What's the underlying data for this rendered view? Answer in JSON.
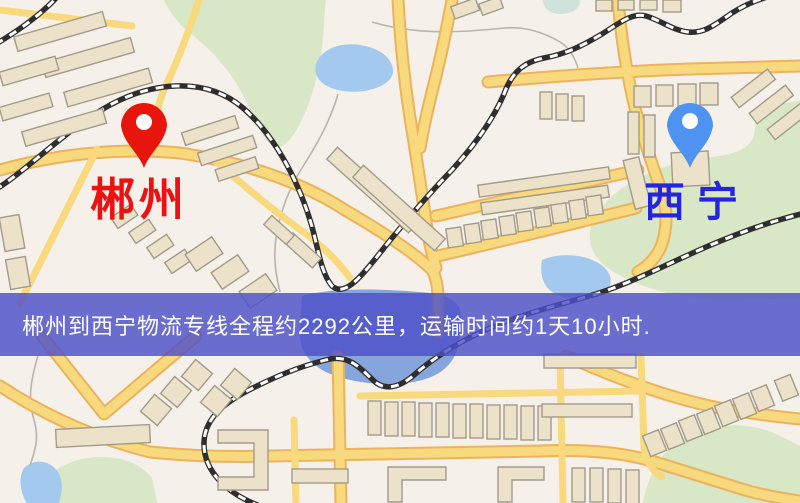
{
  "map": {
    "origin": {
      "name": "郴州",
      "pin_color": "#e8150c",
      "label_color": "#ee1111"
    },
    "destination": {
      "name": "西宁",
      "pin_color": "#4f93f2",
      "label_color": "#2525e0"
    },
    "banner": {
      "text": "郴州到西宁物流专线全程约2292公里，运输时间约1天10小时.",
      "bg_color": "rgba(77,79,200,0.82)",
      "text_color": "#ffffff"
    },
    "palette": {
      "background": "#f5f0e9",
      "road_fill": "#f8d97d",
      "road_casing": "#ecb35f",
      "building_fill": "#ebe2c9",
      "building_outline": "#a39b8a",
      "green_area": "#d8e7c5",
      "teal_area": "#cfe3da",
      "water": "#a3c9ee",
      "water_dark": "#86a5dd",
      "railway": "#2e2e2e",
      "railway_dash": "#ffffff",
      "stream": "#b9b4ac"
    }
  }
}
